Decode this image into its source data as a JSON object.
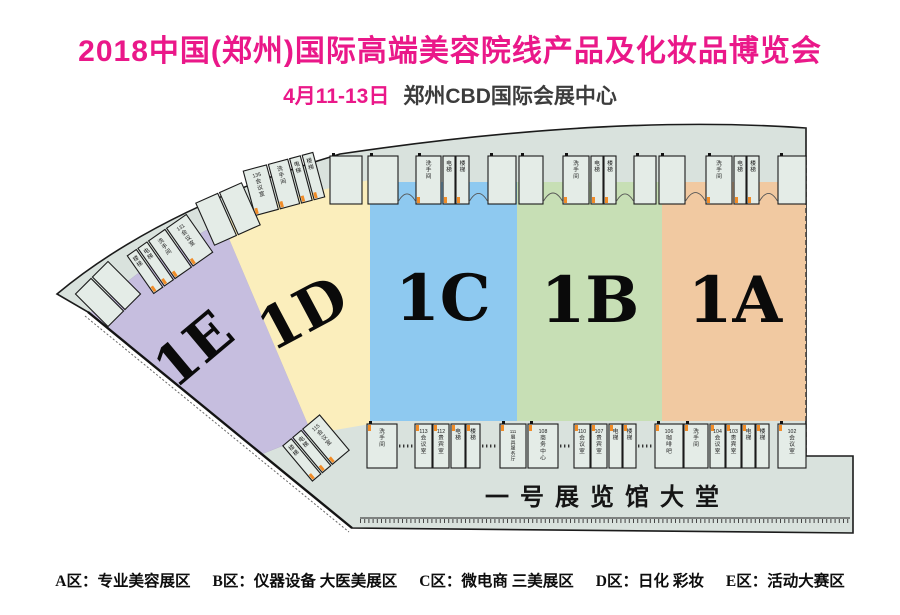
{
  "header": {
    "title": "2018中国(郑州)国际高端美容院线产品及化妆品博览会",
    "date": "4月11-13日",
    "venue": "郑州CBD国际会展中心"
  },
  "colors": {
    "accent": "#ea1889",
    "hall_floor": "#d9e2dd",
    "booth_fill": "#e4ece7",
    "wall": "#1b1b1b",
    "door_mark": "#f08c28"
  },
  "map": {
    "lobby_label": "一号展览馆大堂",
    "zones": [
      {
        "id": "1E",
        "label": "1E",
        "color": "#c6bedf"
      },
      {
        "id": "1D",
        "label": "1D",
        "color": "#fbeebc"
      },
      {
        "id": "1C",
        "label": "1C",
        "color": "#8ec9f0"
      },
      {
        "id": "1B",
        "label": "1B",
        "color": "#c7dfb5"
      },
      {
        "id": "1A",
        "label": "1A",
        "color": "#f1c9a1"
      }
    ],
    "top_booths": [
      {
        "x": 330,
        "w": 32,
        "label": ""
      },
      {
        "x": 368,
        "w": 30,
        "label": ""
      },
      {
        "x": 416,
        "w": 25,
        "label": "洗手间"
      },
      {
        "x": 443,
        "w": 12,
        "label": "电梯"
      },
      {
        "x": 456,
        "w": 13,
        "label": "楼梯"
      },
      {
        "x": 488,
        "w": 28,
        "label": ""
      },
      {
        "x": 519,
        "w": 24,
        "label": ""
      },
      {
        "x": 563,
        "w": 26,
        "label": "洗手间"
      },
      {
        "x": 591,
        "w": 12,
        "label": "电梯"
      },
      {
        "x": 604,
        "w": 12,
        "label": "楼梯"
      },
      {
        "x": 634,
        "w": 22,
        "label": ""
      },
      {
        "x": 659,
        "w": 26,
        "label": ""
      },
      {
        "x": 706,
        "w": 26,
        "label": "洗手间"
      },
      {
        "x": 734,
        "w": 12,
        "label": "电梯"
      },
      {
        "x": 747,
        "w": 12,
        "label": "楼梯"
      },
      {
        "x": 778,
        "w": 28,
        "label": ""
      }
    ],
    "arc_groups": [
      {
        "cx": 284,
        "cy": 68,
        "rot": -15,
        "booths": [
          {
            "w": 24,
            "label": "135会议室"
          },
          {
            "w": 20,
            "label": "洗手间"
          },
          {
            "w": 11,
            "label": "电梯"
          },
          {
            "w": 11,
            "label": "楼梯"
          }
        ]
      },
      {
        "cx": 228,
        "cy": 98,
        "rot": -24,
        "booths": [
          {
            "w": 24,
            "label": ""
          },
          {
            "w": 24,
            "label": ""
          }
        ]
      },
      {
        "cx": 170,
        "cy": 138,
        "rot": -35,
        "booths": [
          {
            "w": 11,
            "label": "楼梯"
          },
          {
            "w": 11,
            "label": "电梯"
          },
          {
            "w": 20,
            "label": "洗手间"
          },
          {
            "w": 24,
            "label": "131会议室"
          }
        ]
      },
      {
        "cx": 108,
        "cy": 178,
        "rot": -45,
        "booths": [
          {
            "w": 22,
            "label": ""
          },
          {
            "w": 22,
            "label": ""
          }
        ]
      },
      {
        "cx": 316,
        "cy": 332,
        "rot": -40,
        "booths": [
          {
            "w": 11,
            "label": "楼梯"
          },
          {
            "w": 11,
            "label": "电梯"
          },
          {
            "w": 22,
            "label": "115会议室"
          }
        ]
      }
    ],
    "bottom_booths": [
      {
        "x": 367,
        "w": 30,
        "label": "洗手间"
      },
      {
        "x": 415,
        "w": 17,
        "label": "113会议室"
      },
      {
        "x": 433,
        "w": 16,
        "label": "112贵宾室"
      },
      {
        "x": 451,
        "w": 14,
        "label": "电梯"
      },
      {
        "x": 466,
        "w": 14,
        "label": "楼梯"
      },
      {
        "x": 500,
        "w": 26,
        "label": "111展具服务厅"
      },
      {
        "x": 528,
        "w": 30,
        "label": "108商务中心"
      },
      {
        "x": 574,
        "w": 16,
        "label": "110会议室"
      },
      {
        "x": 591,
        "w": 16,
        "label": "107贵宾室"
      },
      {
        "x": 609,
        "w": 13,
        "label": "电梯"
      },
      {
        "x": 623,
        "w": 13,
        "label": "楼梯"
      },
      {
        "x": 655,
        "w": 28,
        "label": "106咖啡吧"
      },
      {
        "x": 684,
        "w": 24,
        "label": "洗手间"
      },
      {
        "x": 710,
        "w": 15,
        "label": "104会议室"
      },
      {
        "x": 726,
        "w": 15,
        "label": "103贵宾室"
      },
      {
        "x": 742,
        "w": 13,
        "label": "电梯"
      },
      {
        "x": 756,
        "w": 13,
        "label": "楼梯"
      },
      {
        "x": 778,
        "w": 28,
        "label": "102会议室"
      }
    ]
  },
  "legend": {
    "items": [
      {
        "zone": "A区",
        "desc": "专业美容展区"
      },
      {
        "zone": "B区",
        "desc": "仪器设备 大医美展区"
      },
      {
        "zone": "C区",
        "desc": "微电商 三美展区"
      },
      {
        "zone": "D区",
        "desc": "日化 彩妆"
      },
      {
        "zone": "E区",
        "desc": "活动大赛区"
      }
    ]
  }
}
